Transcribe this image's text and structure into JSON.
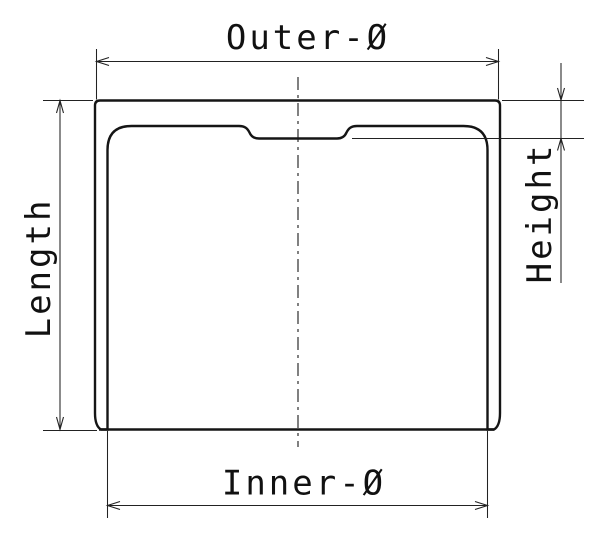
{
  "diagram": {
    "type": "technical-cross-section-drawing",
    "subject": "hollow cylindrical cup (tappet) sectional view with dimension annotations",
    "labels": {
      "outer_diameter": "Outer-Ø",
      "inner_diameter": "Inner-Ø",
      "length": "Length",
      "height": "Height"
    },
    "colors": {
      "line": "#1a1a1a",
      "background": "#ffffff",
      "hatch": "#1a1a1a"
    }
  }
}
